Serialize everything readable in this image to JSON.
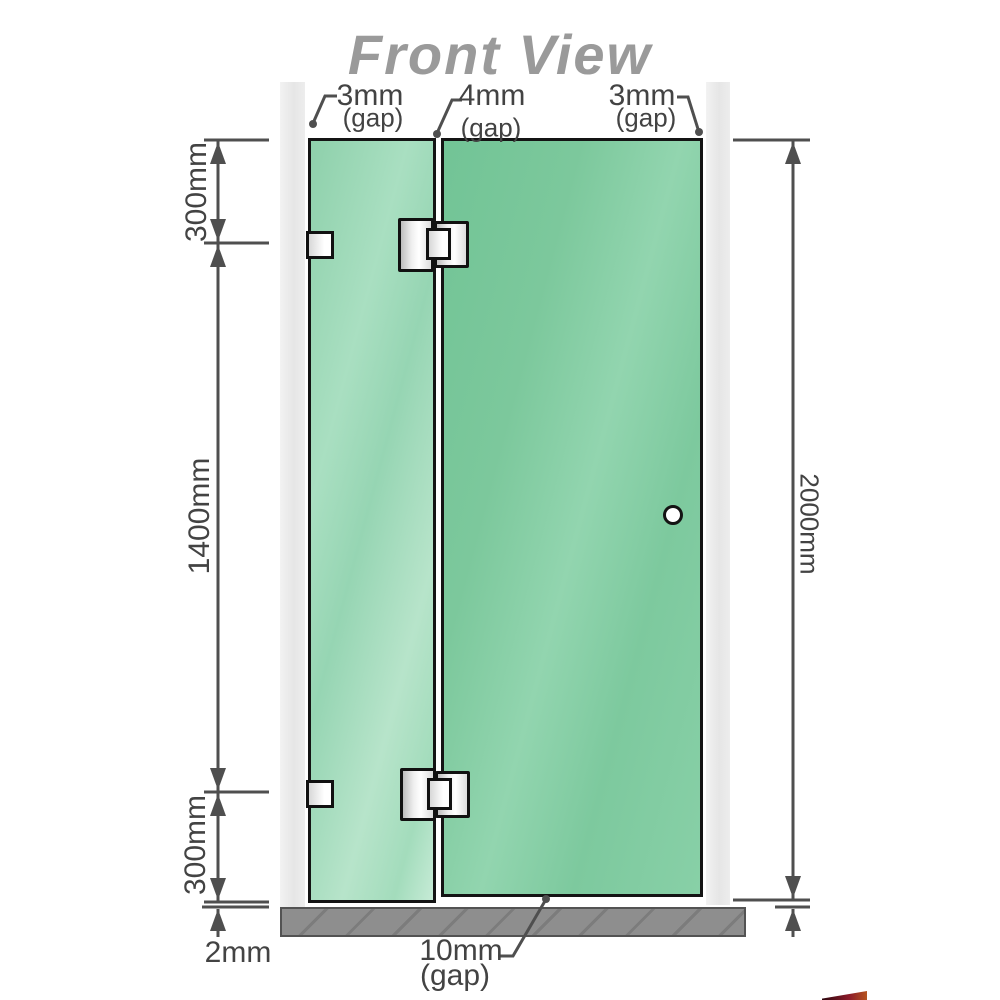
{
  "title": "Front View",
  "view_type": "shower screen front elevation diagram",
  "gaps": {
    "left": {
      "value": "3mm",
      "note": "(gap)"
    },
    "middle": {
      "value": "4mm",
      "note": "(gap)"
    },
    "right": {
      "value": "3mm",
      "note": "(gap)"
    },
    "bottom": {
      "value": "10mm",
      "note": "(gap)"
    },
    "floor_left": {
      "value": "2mm"
    }
  },
  "dimensions": {
    "left_top": "300mm",
    "left_middle": "1400mm",
    "left_bottom": "300mm",
    "right_total": "2000mm"
  },
  "colors": {
    "title": "#9a9a9a",
    "dimension_lines": "#4f4f4f",
    "glass_fixed_panel": "#9bd6b5",
    "glass_door_panel": "#7cc89d",
    "wall": "#eaeaea",
    "floor": "#8e8e8e",
    "hardware": "#e8e8e8",
    "logo_red": "#8c1b2a"
  }
}
